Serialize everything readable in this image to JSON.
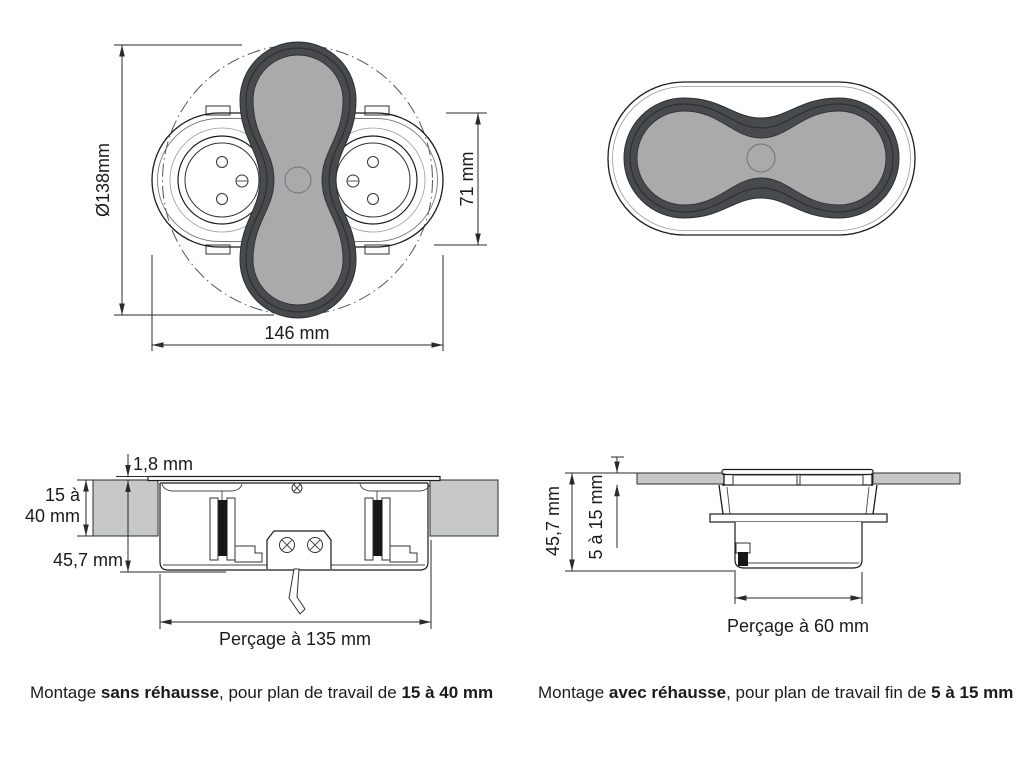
{
  "colors": {
    "line": "#1c1c1c",
    "cover_dark": "#474b4e",
    "cover_inner": "#a9abab",
    "worktop_fill": "#c7c9c9",
    "dim_text": "#1b1b1b"
  },
  "top_view_open": {
    "dim_diameter": "Ø138mm",
    "dim_width": "146 mm",
    "dim_height": "71 mm"
  },
  "section_sans": {
    "dim_lip": "1,8 mm",
    "dim_worktop_l1": "15 à",
    "dim_worktop_l2": "40 mm",
    "dim_depth": "45,7 mm",
    "dim_drill": "Perçage à 135 mm"
  },
  "section_avec": {
    "dim_depth": "45,7 mm",
    "dim_worktop": "5 à 15 mm",
    "dim_drill": "Perçage à 60 mm"
  },
  "captions": {
    "left": {
      "prefix": "Montage ",
      "bold1": "sans réhausse",
      "middle": ", pour plan de travail de ",
      "bold2": "15 à 40 mm"
    },
    "right": {
      "prefix": "Montage ",
      "bold1": "avec réhausse",
      "middle": ", pour plan de travail fin de ",
      "bold2": "5 à 15 mm"
    }
  }
}
